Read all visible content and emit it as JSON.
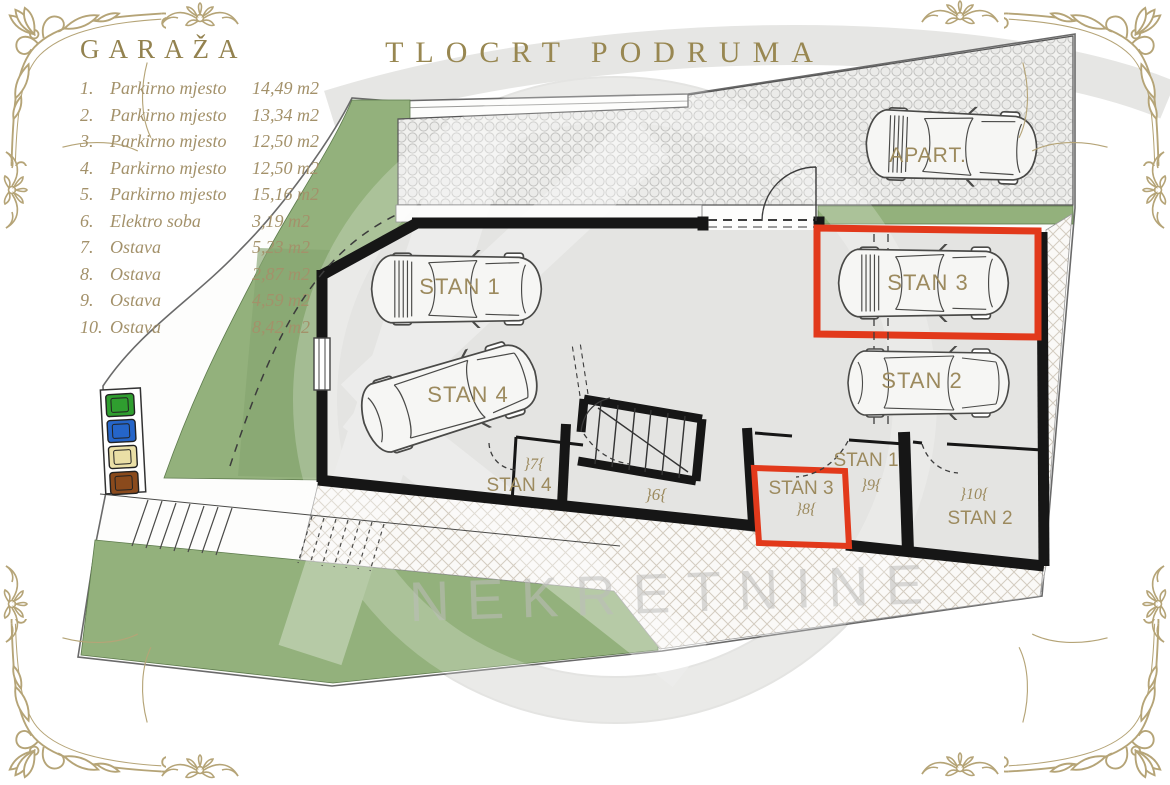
{
  "title": "TLOCRT PODRUMA",
  "legend": {
    "title": "GARAŽA",
    "items": [
      {
        "num": "1.",
        "label": "Parkirno mjesto",
        "area": "14,49 m2"
      },
      {
        "num": "2.",
        "label": "Parkirno mjesto",
        "area": "13,34 m2"
      },
      {
        "num": "3.",
        "label": "Parkirno mjesto",
        "area": "12,50 m2"
      },
      {
        "num": "4.",
        "label": "Parkirno mjesto",
        "area": "12,50 m2"
      },
      {
        "num": "5.",
        "label": "Parkirno mjesto",
        "area": "15,16 m2"
      },
      {
        "num": "6.",
        "label": "Elektro soba",
        "area": "3,19 m2"
      },
      {
        "num": "7.",
        "label": "Ostava",
        "area": "5,23 m2"
      },
      {
        "num": "8.",
        "label": "Ostava",
        "area": "2,87 m2"
      },
      {
        "num": "9.",
        "label": "Ostava",
        "area": "4,59 m2"
      },
      {
        "num": "10.",
        "label": "Ostava",
        "area": "8,42 m2"
      }
    ]
  },
  "watermark": {
    "text": "NEKRETNINE"
  },
  "plan": {
    "cars": {
      "stan1": "STAN 1",
      "stan2": "STAN 2",
      "stan3": "STAN 3",
      "stan4": "STAN 4",
      "apart": "APART."
    },
    "rooms": {
      "stan4_label": "STAN 4",
      "stan4_num": "}7{",
      "room6_num": "}6{",
      "stan3_label": "STAN 3",
      "stan3_num": "}8{",
      "stan1_label": "STAN 1",
      "stan1_num": "}9{",
      "stan2_label": "STAN 2",
      "stan2_num": "}10{"
    },
    "colors": {
      "highlight": "#e2391b",
      "green": "#93b17c",
      "green_dark": "#85a470",
      "gold": "#9c8a5e",
      "wall": "#161616",
      "ornament": "#b5a477"
    },
    "bins": [
      "#2f9e2f",
      "#2565c9",
      "#eadfa6",
      "#8a4a1c"
    ]
  }
}
